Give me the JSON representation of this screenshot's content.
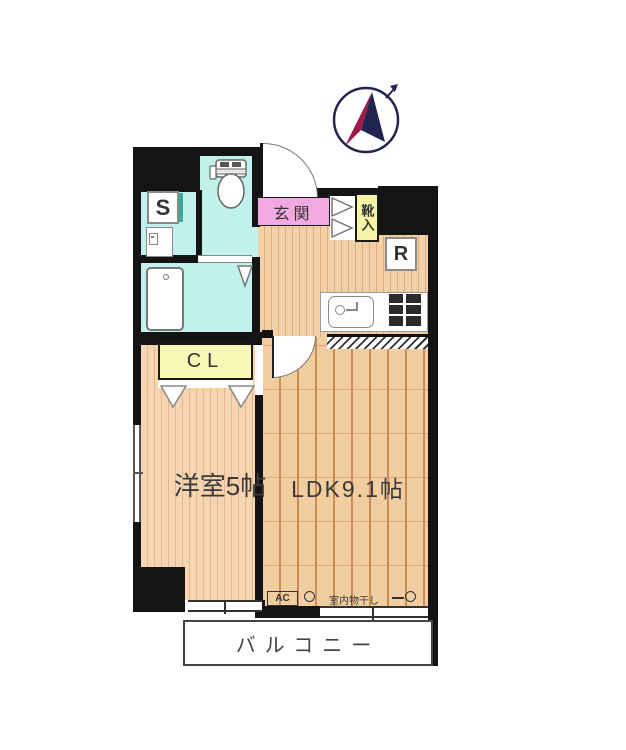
{
  "plan_title": "apartment-floor-plan",
  "compass": {
    "north_label": "N",
    "red": "#9e1b4a",
    "navy": "#23234f"
  },
  "rooms": {
    "entrance": {
      "label": "玄関",
      "fill": "#f2a8e0"
    },
    "shoe_box": {
      "label": "靴入",
      "fill": "#f7f4a6"
    },
    "storage": {
      "label": "S"
    },
    "refrigerator": {
      "label": "R"
    },
    "closet": {
      "label": "CL",
      "fill": "#f9f9b6"
    },
    "western_room": {
      "label": "洋室5帖"
    },
    "ldk": {
      "label": "LDK9.1帖"
    },
    "balcony": {
      "label": "バルコニー"
    }
  },
  "annotations": {
    "ac": "AC",
    "indoor_drying": "室内物干し"
  },
  "fixtures": {
    "toilet": "toilet",
    "bathtub": "bathtub",
    "washer": "washing-machine",
    "sink": "kitchen-sink",
    "stove": "stove"
  },
  "colors": {
    "wall": "#141414",
    "sanitary": "#c2f1ec",
    "wood": "#f2cda0"
  }
}
